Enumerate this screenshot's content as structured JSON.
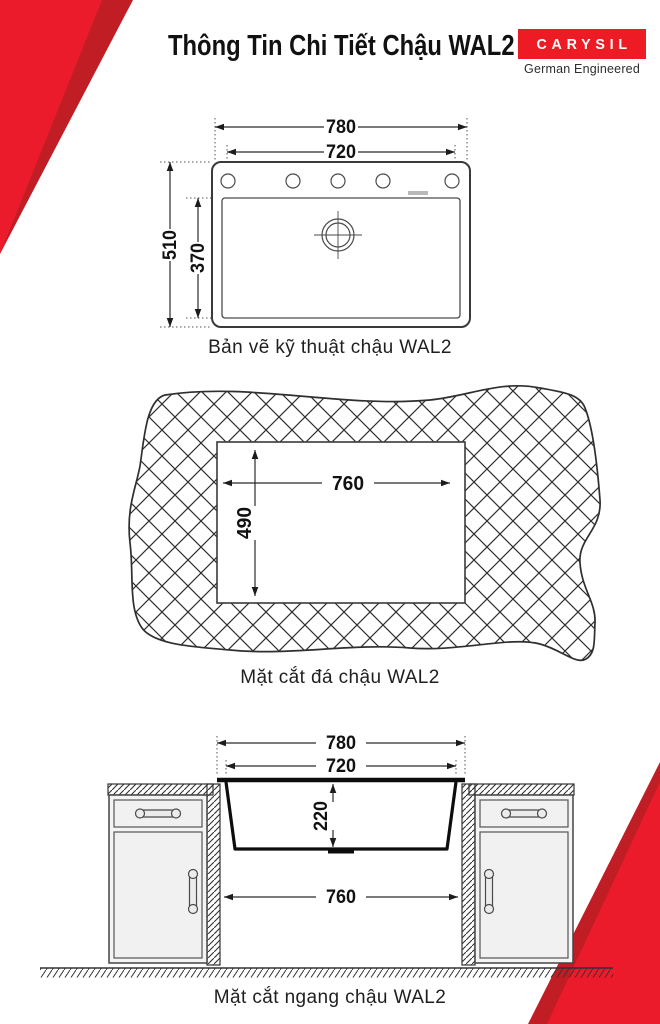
{
  "header": {
    "title": "Thông Tin Chi Tiết Chậu WAL2",
    "brand": "CARYSIL",
    "brand_tagline": "German Engineered"
  },
  "colors": {
    "accent_red": "#ED1C24",
    "accent_red_dark": "#C11D25",
    "line_dark": "#2b2b2b"
  },
  "top_view": {
    "caption": "Bản vẽ kỹ thuật chậu WAL2",
    "dim_outer_width": "780",
    "dim_inner_width": "720",
    "dim_outer_depth": "510",
    "dim_inner_depth": "370"
  },
  "stone_cutout": {
    "caption": "Mặt cắt đá chậu WAL2",
    "dim_cutout_width": "760",
    "dim_cutout_depth": "490"
  },
  "cross_section": {
    "caption": "Mặt cắt ngang chậu WAL2",
    "dim_outer_width": "780",
    "dim_inner_width": "720",
    "dim_bowl_depth": "220",
    "dim_cabinet_opening": "760"
  }
}
